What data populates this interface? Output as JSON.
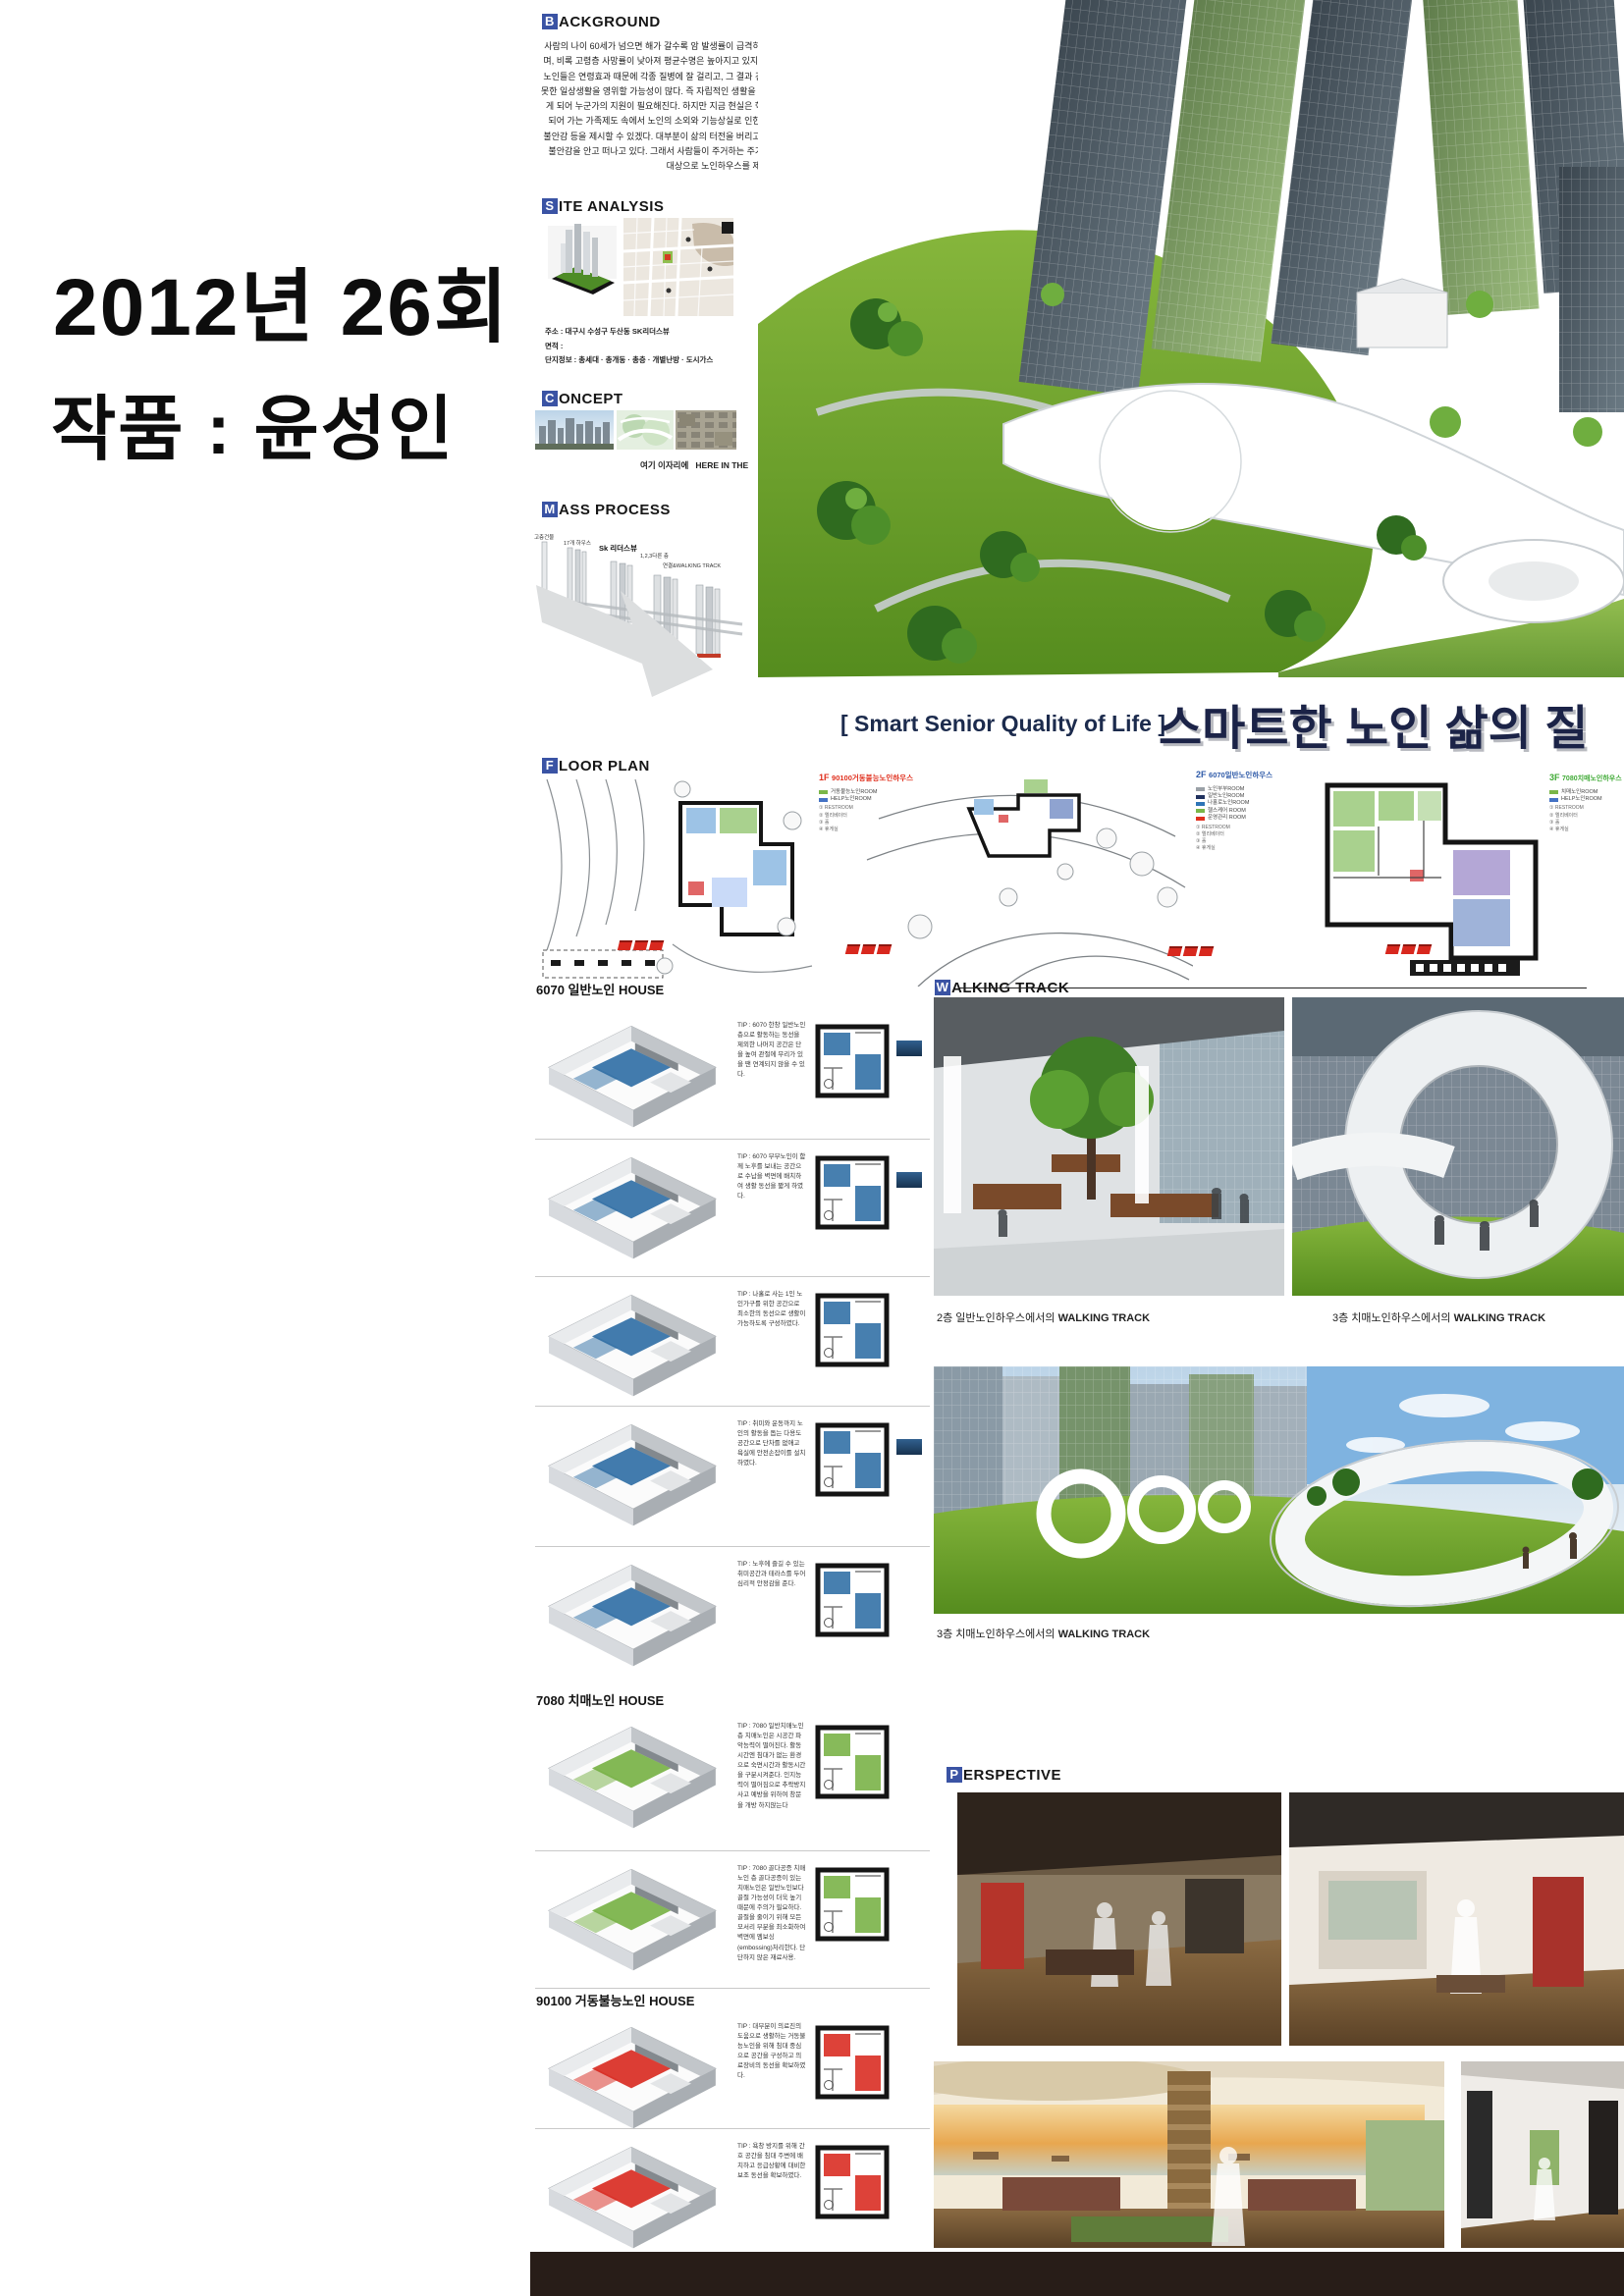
{
  "credit": {
    "line1": "2012년 26회",
    "line2": "작품 : 윤성인"
  },
  "title": {
    "en": "[ Smart Senior Quality of Life ]",
    "ko": "스마트한 노인 삶의 질",
    "color": "#1b2347"
  },
  "sections": {
    "background": {
      "cap": "B",
      "rest": "ACKGROUND",
      "body": "사람의 나이 60세가 넘으면 해가 갈수록 암 발생률이 급격히 높아지며, 비록 고령층 사망률이 낮아져 평균수명은 높아지고 있지만, 후기노인들은 연령효과 때문에 각종 질병에 잘 걸리고, 그 결과 건강하지 못한 일상생활을 영위할 가능성이 많다. 즉 자립적인 생활을 할 수 없게 되어 누군가의 지원이 필요해진다. 하지만 지금 현실은 핵가족화 되어 가는 가족제도 속에서 노인의 소외와 기능상실로 인한 심리적 불안감 등을 제시할 수 있겠다. 대부분이 삶의 터전을 버리고 심리적 불안감을 안고 떠나고 있다. 그래서 사람들이 주거하는 주거단지를 대상으로 노인하우스를 제안한다."
    },
    "site_analysis": {
      "cap": "S",
      "rest": "ITE ANALYSIS",
      "lines": [
        "주소 : 대구시 수성구 두산동 SK리더스뷰",
        "면적 : ",
        "단지정보 : 총세대 · 총개동 · 총층 · 개별난방 · 도시가스"
      ]
    },
    "concept": {
      "cap": "C",
      "rest": "ONCEPT",
      "caption_ko": "여기 이자리에",
      "caption_en": "HERE IN THE"
    },
    "mass_process": {
      "cap": "M",
      "rest": "ASS PROCESS",
      "steps": [
        "고층건물",
        "17개 하우스",
        "Sk 리더스뷰",
        "1,2,3다른 층",
        "연결&WALKING TRACK"
      ]
    },
    "floor_plan": {
      "cap": "F",
      "rest": "LOOR PLAN",
      "plans": [
        {
          "tag": "1F",
          "name": "90100거동불능노인하우스",
          "color": "#e0301e",
          "legend": [
            {
              "label": "거동불능노인ROOM"
            },
            {
              "label": "HELP노인ROOM"
            }
          ],
          "notes": [
            "① RESTROOM",
            "② 엘리베이터",
            "③ 홀",
            "④ 휴게실"
          ]
        },
        {
          "tag": "2F",
          "name": "6070일반노인하우스",
          "color": "#2e5aa8",
          "legend": [
            {
              "label": "노인부부ROOM"
            },
            {
              "label": "일반노인ROOM"
            },
            {
              "label": "나홀로노인ROOM"
            },
            {
              "label": "헬스케어 ROOM"
            },
            {
              "label": "운영관리 ROOM"
            }
          ],
          "notes": [
            "① RESTROOM",
            "② 엘리베이터",
            "③ 홀",
            "④ 휴게실"
          ]
        },
        {
          "tag": "3F",
          "name": "7080치매노인하우스",
          "color": "#3faa35",
          "legend": [
            {
              "label": "치매노인ROOM"
            },
            {
              "label": "HELP노인ROOM"
            }
          ],
          "notes": [
            "① RESTROOM",
            "② 엘리베이터",
            "③ 홀",
            "④ 휴게실"
          ]
        }
      ]
    },
    "walking_track": {
      "cap": "W",
      "rest": "ALKING TRACK",
      "caption_left_pre": "2층 일반노인하우스에서의 ",
      "caption_left_strong": "WALKING TRACK",
      "caption_right_pre": "3층 치매노인하우스에서의 ",
      "caption_right_strong": "WALKING TRACK",
      "caption_big_pre": "3층 치매노인하우스에서의 ",
      "caption_big_strong": "WALKING TRACK"
    },
    "perspective": {
      "cap": "P",
      "rest": "ERSPECTIVE"
    }
  },
  "houses": [
    {
      "title": "6070 일반노인 HOUSE",
      "accent": "#2e6da4",
      "units": [
        {
          "tip": "TIP : 6070 한창 일반노인 층으로 활동하는 동선을 제외한 나머지 공간은 단을 높여 관절에 무리가 있을 땐 연계되지 않을 수 있다."
        },
        {
          "tip": "TIP : 6070 부부노인이 함께 노후를 보내는 공간으로 수납을 벽면에 배치하여 생활 동선을 짧게 하였다."
        },
        {
          "tip": "TIP : 나홀로 사는 1인 노인가구를 위한 공간으로 최소한의 동선으로 생활이 가능하도록 구성하였다."
        },
        {
          "tip": "TIP : 취미와 운동까지 노인의 활동을 돕는 다용도 공간으로 단차를 없애고 욕실에 안전손잡이를 설치하였다."
        },
        {
          "tip": "TIP : 노후에 즐길 수 있는 취미공간과 테라스를 두어 심리적 안정감을 준다."
        }
      ]
    },
    {
      "title": "7080 치매노인 HOUSE",
      "accent": "#76b043",
      "units": [
        {
          "tip": "TIP : 7080 일반치매노인 층 치매노인은 시공간 파악능력이 떨어진다. 활동시간엔 침대가 없는 환경으로 숙면시간과 활동시간을 구분시켜준다. 인지능력이 떨어짐으로 추락방지사고 예방을 위하여 창문을 개방 하지않는다"
        },
        {
          "tip": "TIP : 7080 골다공증 치매노인 층 골다공증이 있는 치매노인은 일반노인보다 골절 가능성이 더욱 높기 때문에 주의가 필요하다. 골절을 줄이기 위해 모든 모서리 부분을 최소화하여 벽면에 엠보싱(embossing)처리한다. 단단하지 않은 재료사용."
        }
      ]
    },
    {
      "title": "90100 거동불능노인 HOUSE",
      "accent": "#d8281e",
      "units": [
        {
          "tip": "TIP : 대부분이 의료진의 도움으로 생활하는 거동불능노인을 위해 침대 중심으로 공간을 구성하고 의료장비의 동선을 확보하였다."
        },
        {
          "tip": "TIP : 욕창 방지를 위해 간호 공간을 침대 주변에 배치하고 응급상황에 대비한 보조 동선을 확보하였다."
        }
      ]
    }
  ],
  "colors": {
    "header_box": "#3a53a4",
    "plan_1f": "#e0301e",
    "plan_2f": "#2e5aa8",
    "plan_3f": "#3faa35",
    "lawn": "#6aa52e",
    "bottom_bar": "#281d18"
  }
}
